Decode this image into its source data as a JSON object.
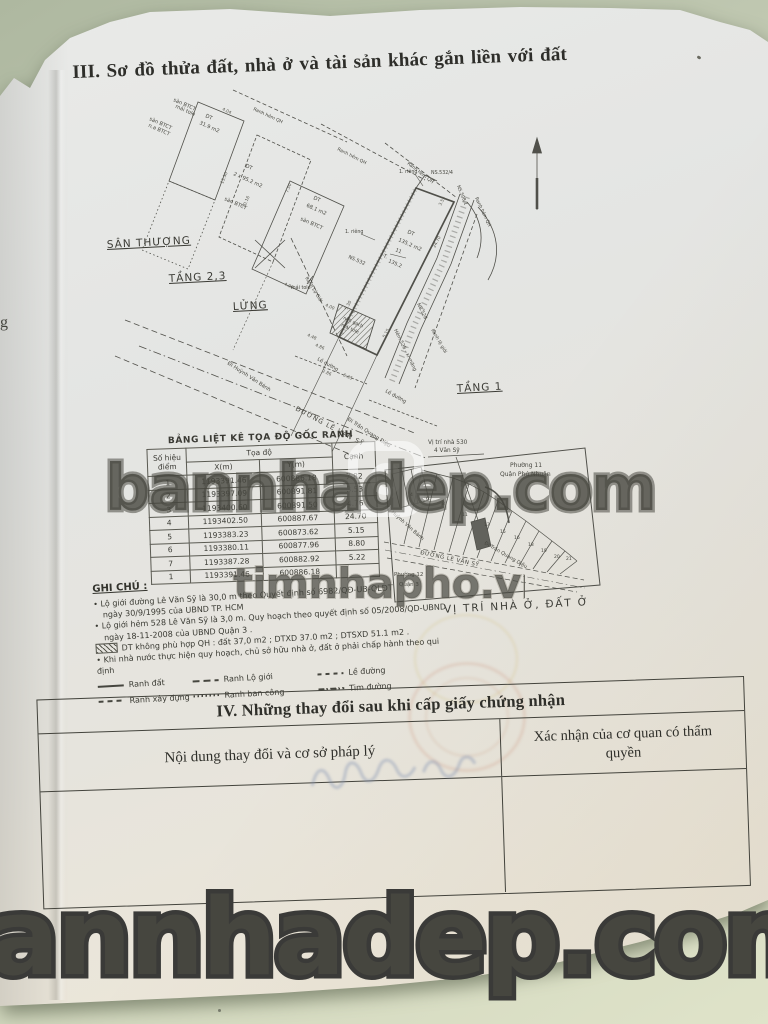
{
  "page": {
    "section3_title": "III. Sơ đồ thửa đất, nhà ở và tài sản khác gắn liền với đất",
    "prev_page_fragment": "g"
  },
  "drawing": {
    "labels": [
      "sàn BTCT",
      "mái tole",
      "DT",
      "31.9 m2",
      "sàn BTCT",
      "n.a BTCT",
      "Ranh hẻm QH",
      "Ranh hẻm QH",
      "Ranh hẻm QH",
      "Ranh hẻm QH",
      "DT",
      "2 x 95.2 m2",
      "sàn BTCT",
      "DT",
      "68.1 m2",
      "sàn BTCT",
      "mái tole",
      "1. riêng",
      "NS.532/4",
      "NS.508/1",
      "1. riêng",
      "DT",
      "135.2 m2",
      "T.",
      "11",
      "135.2",
      "NS.532",
      "Ranh Lộ Giới",
      "nền gạch",
      "mái tole",
      "Hẻm 528 - xi măng",
      "NS.528",
      "Ranh lộ giới",
      "Lề đường",
      "Lề đường",
      "Đi Huỳnh Văn Bánh",
      "ĐƯỜNG LÊ VĂN SỸ",
      "Đi Trần Quang Diệu",
      "SÂN THƯỢNG",
      "TẦNG 2,3",
      "LỬNG",
      "TẦNG 1"
    ],
    "dims": [
      "4.04",
      "7.50",
      "13.50",
      "10.16",
      "4.90",
      "4.00",
      "4.86",
      "5.30",
      "24.70",
      "2.86",
      "5.35",
      "4.48",
      "3.53",
      "5.15"
    ]
  },
  "coord_table": {
    "title": "BẢNG LIỆT KÊ TỌA ĐỘ GỐC RANH",
    "headers": {
      "point": "Số hiệu điểm",
      "coords": "Tọa độ",
      "x": "X(m)",
      "y": "Y(m)",
      "edge": "Cạnh"
    },
    "rows": [
      {
        "point": "1",
        "x": "1193391.46",
        "y": "600886.18",
        "edge": "7.82"
      },
      {
        "point": "2",
        "x": "1193397.09",
        "y": "600891.81",
        "edge": "3.53"
      },
      {
        "point": "3",
        "x": "1193400.60",
        "y": "600891.50",
        "edge": "4.76"
      },
      {
        "point": "4",
        "x": "1193402.50",
        "y": "600887.67",
        "edge": "24.70"
      },
      {
        "point": "5",
        "x": "1193383.23",
        "y": "600873.62",
        "edge": "5.15"
      },
      {
        "point": "6",
        "x": "1193380.11",
        "y": "600877.96",
        "edge": "8.80"
      },
      {
        "point": "7",
        "x": "1193387.28",
        "y": "600882.92",
        "edge": "5.22"
      },
      {
        "point": "1",
        "x": "1193391.46",
        "y": "600886.18",
        "edge": ""
      }
    ]
  },
  "location_map": {
    "caption": "VỊ TRÍ NHÀ Ở, ĐẤT Ở",
    "labels": [
      "Vị trí nhà 530",
      "4 Văn Sỹ",
      "Phường 11",
      "Quận Phú Nhuận",
      "Đi Huỳnh Văn Bánh",
      "ĐƯỜNG LÊ VĂN SỸ",
      "Đi Trần Quang Diệu",
      "Phường 12",
      "Quận 3"
    ],
    "lot_numbers": [
      "4",
      "6",
      "8",
      "11",
      "13",
      "15",
      "16",
      "18",
      "19",
      "20",
      "21"
    ]
  },
  "notes": {
    "heading": "GHI CHÚ :",
    "lines": [
      "Lộ giới đường Lê Văn Sỹ là 30,0 m theo Quyết định số 6982/QĐ-UB-QLĐT",
      "ngày 30/9/1995 của UBND TP. HCM",
      "Lộ giới hẻm 528 Lê Văn Sỹ là 3,0 m. Quy hoạch theo quyết định số 05/2008/QD-UBND",
      "ngày 18-11-2008 của UBND Quận 3 .",
      "DT không phù hợp QH : đất 37,0 m2 ; DTXD 37.0 m2 ; DTSXD 51.1 m2 .",
      "Khi nhà nước thực hiện quy hoạch, chủ sở hữu nhà ở, đất ở phải chấp hành theo qui định"
    ],
    "legend": [
      {
        "style": "solid",
        "label": "Ranh đất"
      },
      {
        "style": "dash-long",
        "label": "Ranh Lộ giới"
      },
      {
        "style": "dash-short",
        "label": "Lề đường"
      },
      {
        "style": "dash-med",
        "label": "Ranh xây dựng"
      },
      {
        "style": "dotted",
        "label": "Ranh ban công"
      },
      {
        "style": "dash-dot",
        "label": "Tim đường"
      }
    ]
  },
  "section4": {
    "title": "IV. Những thay đổi sau khi cấp giấy chứng nhận",
    "col_left": "Nội dung thay đổi và cơ sở pháp lý",
    "col_right": "Xác nhận của cơ quan có thẩm quyền"
  },
  "watermarks": {
    "center": "bannhadep.com",
    "center2": "timnhapho.vn",
    "bottom": "annhadep.com"
  },
  "colors": {
    "surface": "#c3cbb2",
    "paper": "#e6e7e4",
    "ink": "#3c3c38",
    "seal_red": "#c17656",
    "seal_yellow": "#cbb25c"
  }
}
